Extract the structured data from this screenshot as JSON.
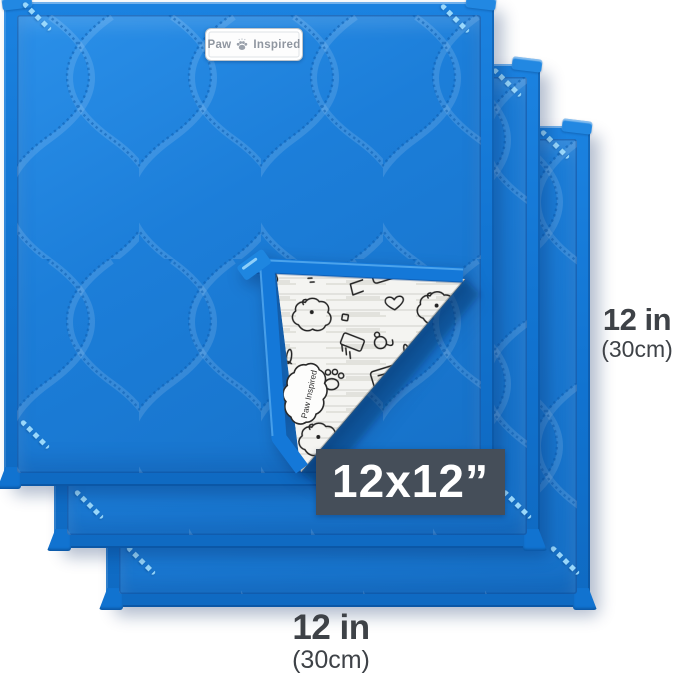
{
  "brand_tag": {
    "word_left": "Paw",
    "word_right": "Inspired"
  },
  "size_badge": {
    "text": "12x12”"
  },
  "dimension_right": {
    "inches": "12 in",
    "metric": "(30cm)"
  },
  "dimension_bottom": {
    "inches": "12 in",
    "metric": "(30cm)"
  },
  "flap": {
    "logo_text": "Paw Inspired",
    "pattern_name": "pet-doodle-print"
  },
  "pads": {
    "count": 3
  },
  "colors": {
    "pad_blue": "#1c7ed9",
    "binding_blue": "#1173d0",
    "badge_bg": "#454e59",
    "badge_text": "#ffffff",
    "dimension_text": "#3e4247",
    "corner_stitch": "#a0deff",
    "doodle_ink": "#222222",
    "tag_text": "#8f96a0",
    "background": "#ffffff"
  }
}
